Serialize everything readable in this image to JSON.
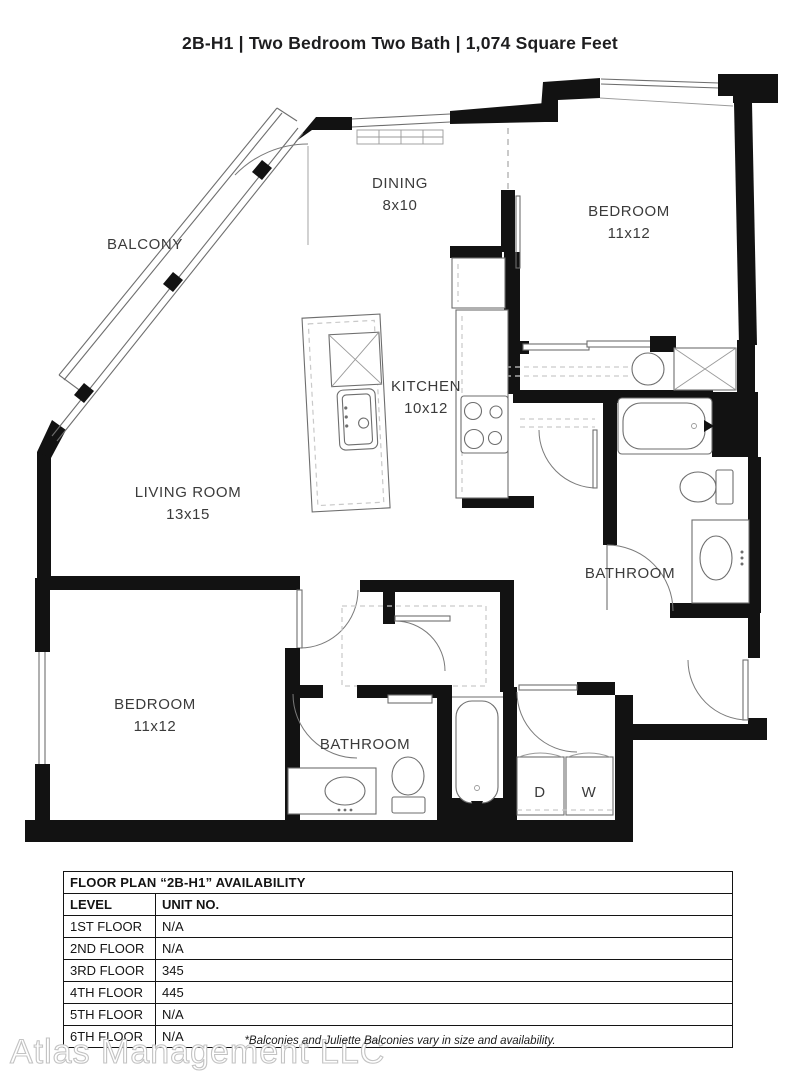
{
  "title": "2B-H1 | Two Bedroom Two Bath | 1,074 Square Feet",
  "plan": {
    "labels": {
      "balcony": "BALCONY",
      "dining": {
        "name": "DINING",
        "dims": "8x10"
      },
      "bedroom1": {
        "name": "BEDROOM",
        "dims": "11x12"
      },
      "kitchen": {
        "name": "KITCHEN",
        "dims": "10x12"
      },
      "living": {
        "name": "LIVING ROOM",
        "dims": "13x15"
      },
      "bathroom1": "BATHROOM",
      "bedroom2": {
        "name": "BEDROOM",
        "dims": "11x12"
      },
      "bathroom2": "BATHROOM",
      "dryer": "D",
      "washer": "W"
    },
    "colors": {
      "wall": "#121212",
      "line": "#6e6e6e",
      "text": "#3b3b3b"
    }
  },
  "table": {
    "title": "FLOOR PLAN “2B-H1” AVAILABILITY",
    "columns": [
      "LEVEL",
      "UNIT NO."
    ],
    "rows": [
      [
        "1ST FLOOR",
        "N/A"
      ],
      [
        "2ND FLOOR",
        "N/A"
      ],
      [
        "3RD FLOOR",
        "345"
      ],
      [
        "4TH FLOOR",
        "445"
      ],
      [
        "5TH FLOOR",
        "N/A"
      ],
      [
        "6TH FLOOR",
        "N/A"
      ]
    ]
  },
  "footnote": "*Balconies and Juliette Balconies vary in size and availability.",
  "watermark": "Atlas Management LLC"
}
